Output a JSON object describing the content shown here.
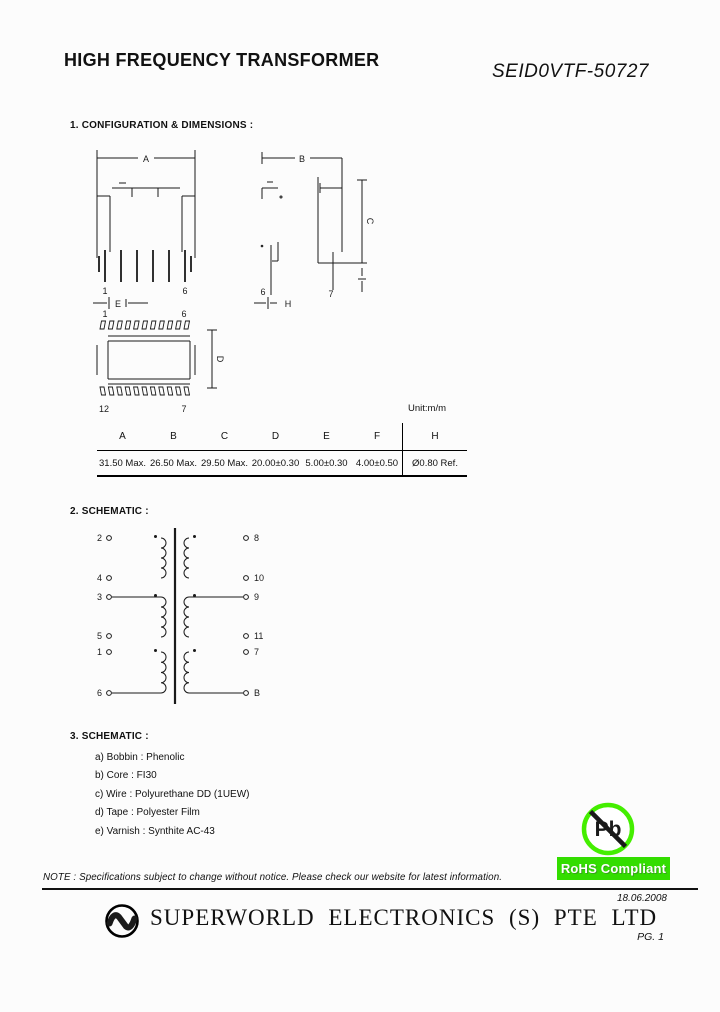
{
  "page": {
    "title": "HIGH FREQUENCY TRANSFORMER",
    "part_number": "SEID0VTF-50727",
    "date": "18.06.2008",
    "page_label": "PG. 1"
  },
  "section1": {
    "heading": "1. CONFIGURATION & DIMENSIONS :",
    "unit_label": "Unit:m/m",
    "drawing": {
      "front": {
        "dim_a": "A",
        "dim_e": "E",
        "pin1": "1",
        "pin6": "6"
      },
      "side": {
        "dim_b": "B",
        "dim_c": "C",
        "dim_h": "H",
        "pin6": "6",
        "pin7": "7"
      },
      "top": {
        "dim_d": "D",
        "pin1": "1",
        "pin6": "6",
        "pin12": "12",
        "pin7": "7"
      }
    },
    "table": {
      "headers": [
        "A",
        "B",
        "C",
        "D",
        "E",
        "F",
        "H"
      ],
      "values": [
        "31.50 Max.",
        "26.50 Max.",
        "29.50 Max.",
        "20.00±0.30",
        "5.00±0.30",
        "4.00±0.50",
        "Ø0.80 Ref."
      ]
    }
  },
  "section2": {
    "heading": "2. SCHEMATIC :",
    "left_pins": [
      "2",
      "4",
      "3",
      "5",
      "1",
      "6"
    ],
    "right_pins": [
      "8",
      "10",
      "9",
      "11",
      "7",
      "B"
    ]
  },
  "section3": {
    "heading": "3. SCHEMATIC :",
    "items": [
      "a) Bobbin : Phenolic",
      "b) Core : FI30",
      "c) Wire : Polyurethane DD (1UEW)",
      "d) Tape : Polyester Film",
      "e) Varnish : Synthite AC-43"
    ]
  },
  "compliance": {
    "pb_symbol": "Pb",
    "badge_label": "RoHS Compliant",
    "badge_green": "#33dd00",
    "symbol_green": "#44ee00"
  },
  "footer": {
    "note": "NOTE : Specifications subject to change without notice. Please check our website for latest information.",
    "company": "SUPERWORLD ELECTRONICS (S) PTE LTD"
  }
}
